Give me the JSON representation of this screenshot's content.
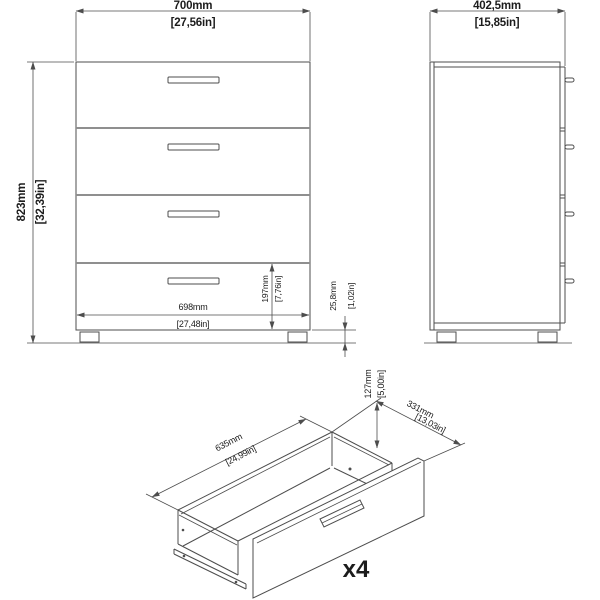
{
  "front_view": {
    "width": {
      "mm": "700mm",
      "in": "[27,56in]"
    },
    "height": {
      "mm": "823mm",
      "in": "[32,39in]"
    },
    "inner_width": {
      "mm": "698mm",
      "in": "[27,48in]"
    },
    "bottom_drawer_front": {
      "mm": "197mm",
      "in": "[7,76in]"
    },
    "leg_height": {
      "mm": "25,8mm",
      "in": "[1,02in]"
    }
  },
  "side_view": {
    "depth": {
      "mm": "402,5mm",
      "in": "[15,85in]"
    }
  },
  "drawer_view": {
    "inner_length": {
      "mm": "635mm",
      "in": "[24,99in]"
    },
    "inner_depth": {
      "mm": "331mm",
      "in": "[13,03in]"
    },
    "inner_height": {
      "mm": "127mm",
      "in": "[5,00in]"
    },
    "quantity_label": "x4"
  },
  "colors": {
    "line": "#4d4d4d",
    "divider": "#8f8f8f",
    "text": "#1c1c1c",
    "background": "#ffffff"
  }
}
